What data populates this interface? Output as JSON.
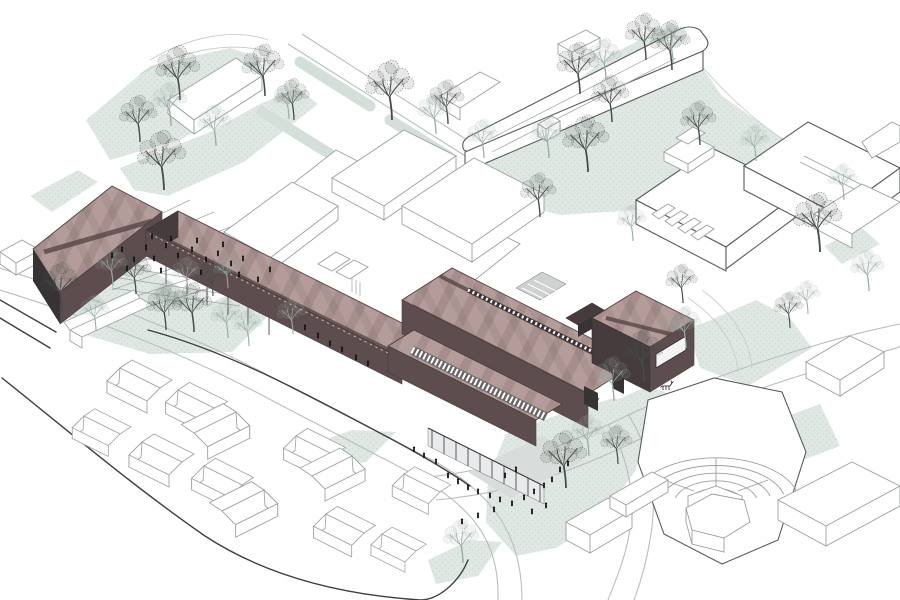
{
  "scene": {
    "kind": "architectural axonometric site illustration",
    "view": "isometric birds-eye",
    "text": []
  },
  "palette": {
    "paper": "#ffffff",
    "outline": "#3f3f3f",
    "outline_soft": "#9aa09e",
    "outline_light": "#b9bebc",
    "green": "#dfe7e3",
    "green_dot": "#c6d2cc",
    "green_strip": "#d5dfda",
    "roof": "#b49c9a",
    "roof_stripe": "#514042",
    "wall": "#5e4d4f",
    "wall_dark": "#463b3d",
    "wall_darker": "#373334",
    "glass": "#e8eaec",
    "deck": "#ced2d0",
    "plaza": "#d8dcda",
    "lattice": "#989e9b",
    "tree_dark": "#454d49",
    "tree_light": "#9aaba4",
    "people": "#141414"
  },
  "highlight_buildings": [
    {
      "id": "wedge-building",
      "color_role": "roof",
      "note": "wedge-shaped maroon building, west end"
    },
    {
      "id": "linear-bar-building",
      "color_role": "roof",
      "note": "long narrow maroon bar on pilotis over plaza"
    },
    {
      "id": "main-hall-building",
      "color_role": "roof",
      "note": "large maroon hall with rooflights and entrance colonnade"
    },
    {
      "id": "annex-building",
      "color_role": "roof",
      "note": "maroon annex box with large opening, linked by bridge"
    }
  ],
  "context_buildings": [
    {
      "id": "northwest-slab"
    },
    {
      "id": "north-slab-with-penthouse"
    },
    {
      "id": "small-cube"
    },
    {
      "id": "central-factory-complex"
    },
    {
      "id": "northeast-complex-with-sawtooth-court"
    },
    {
      "id": "east-box"
    },
    {
      "id": "village-houses",
      "count": 13
    },
    {
      "id": "amphitheatre"
    },
    {
      "id": "south-boxes",
      "count": 4
    },
    {
      "id": "left-edge-box"
    }
  ],
  "landscape": {
    "lattice_plaza": true,
    "lawns": 14,
    "deer_present": true
  },
  "trees": {
    "dark": [
      [
        180,
        100,
        1.05
      ],
      [
        140,
        142,
        0.9
      ],
      [
        164,
        190,
        1.15
      ],
      [
        265,
        96,
        1.0
      ],
      [
        392,
        120,
        1.15
      ],
      [
        448,
        124,
        0.85
      ],
      [
        62,
        312,
        0.95
      ],
      [
        166,
        330,
        0.85
      ],
      [
        136,
        294,
        0.8
      ],
      [
        194,
        332,
        0.95
      ],
      [
        580,
        94,
        1.0
      ],
      [
        646,
        60,
        0.9
      ],
      [
        588,
        172,
        1.1
      ],
      [
        672,
        70,
        0.95
      ],
      [
        612,
        122,
        0.9
      ],
      [
        700,
        145,
        0.85
      ],
      [
        820,
        252,
        1.15
      ],
      [
        790,
        328,
        0.7
      ],
      [
        644,
        382,
        1.0
      ],
      [
        618,
        464,
        0.75
      ],
      [
        566,
        488,
        1.1
      ],
      [
        683,
        303,
        0.75
      ],
      [
        540,
        217,
        0.85
      ],
      [
        213,
        296,
        0.7
      ],
      [
        294,
        120,
        0.8
      ]
    ],
    "light": [
      [
        171,
        126,
        0.85
      ],
      [
        216,
        146,
        0.8
      ],
      [
        289,
        119,
        0.7
      ],
      [
        436,
        134,
        0.8
      ],
      [
        484,
        158,
        0.75
      ],
      [
        113,
        286,
        0.75
      ],
      [
        169,
        316,
        0.7
      ],
      [
        188,
        293,
        0.7
      ],
      [
        228,
        288,
        0.65
      ],
      [
        228,
        338,
        0.75
      ],
      [
        249,
        346,
        0.7
      ],
      [
        293,
        334,
        0.7
      ],
      [
        606,
        80,
        0.8
      ],
      [
        673,
        63,
        0.75
      ],
      [
        549,
        158,
        0.8
      ],
      [
        633,
        241,
        0.7
      ],
      [
        614,
        401,
        0.85
      ],
      [
        686,
        348,
        0.8
      ],
      [
        589,
        456,
        0.8
      ],
      [
        463,
        563,
        0.85
      ],
      [
        869,
        291,
        0.8
      ],
      [
        808,
        314,
        0.65
      ],
      [
        96,
        331,
        0.7
      ],
      [
        756,
        161,
        0.7
      ],
      [
        844,
        200,
        0.7
      ]
    ]
  },
  "people": [
    [
      112,
      258
    ],
    [
      122,
      252
    ],
    [
      134,
      262
    ],
    [
      146,
      250
    ],
    [
      154,
      261
    ],
    [
      166,
      248
    ],
    [
      178,
      258
    ],
    [
      192,
      252
    ],
    [
      206,
      262
    ],
    [
      218,
      256
    ],
    [
      231,
      266
    ],
    [
      243,
      261
    ],
    [
      152,
      239
    ],
    [
      171,
      241
    ],
    [
      197,
      243
    ],
    [
      223,
      247
    ],
    [
      127,
      271
    ],
    [
      161,
      273
    ],
    [
      201,
      275
    ],
    [
      239,
      277
    ],
    [
      258,
      282
    ],
    [
      270,
      272
    ],
    [
      305,
      330
    ],
    [
      318,
      338
    ],
    [
      330,
      346
    ],
    [
      342,
      352
    ],
    [
      356,
      360
    ],
    [
      368,
      366
    ],
    [
      448,
      478
    ],
    [
      458,
      484
    ],
    [
      468,
      490
    ],
    [
      478,
      494
    ],
    [
      490,
      498
    ],
    [
      500,
      502
    ],
    [
      512,
      506
    ],
    [
      524,
      500
    ],
    [
      534,
      494
    ],
    [
      544,
      488
    ],
    [
      552,
      482
    ],
    [
      505,
      478
    ],
    [
      516,
      472
    ],
    [
      494,
      512
    ],
    [
      478,
      518
    ],
    [
      462,
      524
    ],
    [
      532,
      514
    ],
    [
      546,
      508
    ],
    [
      560,
      472
    ],
    [
      568,
      466
    ],
    [
      414,
      452
    ],
    [
      424,
      458
    ],
    [
      436,
      464
    ]
  ],
  "houses": [
    [
      120,
      368,
      1,
      1.0
    ],
    [
      178,
      390,
      1,
      0.95
    ],
    [
      236,
      412,
      -1,
      1.05
    ],
    [
      296,
      436,
      1,
      0.95
    ],
    [
      352,
      456,
      -1,
      1.0
    ],
    [
      404,
      474,
      1,
      0.9
    ],
    [
      84,
      416,
      1,
      0.9
    ],
    [
      142,
      442,
      1,
      1.0
    ],
    [
      204,
      466,
      1,
      0.95
    ],
    [
      264,
      490,
      -1,
      1.05
    ],
    [
      326,
      514,
      1,
      0.95
    ],
    [
      382,
      534,
      1,
      0.85
    ]
  ],
  "deer": {
    "x": 666,
    "y": 390
  }
}
